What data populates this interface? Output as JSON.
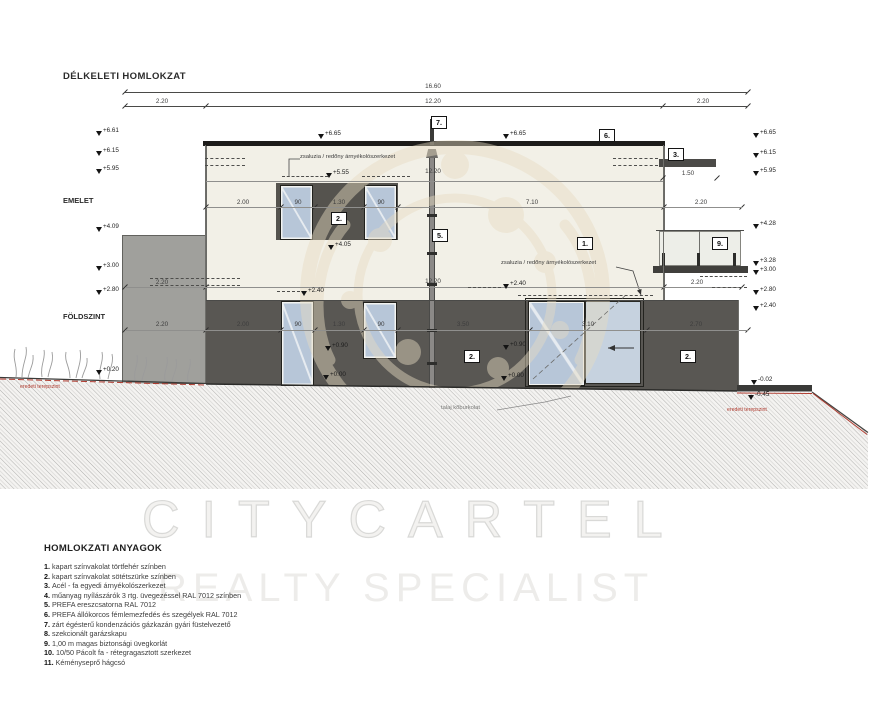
{
  "title": "DÉLKELETI HOMLOKZAT",
  "floors": {
    "upper": "EMELET",
    "ground": "FÖLDSZINT"
  },
  "dims": {
    "total": "16.60",
    "left": "2.20",
    "mid": "12.20",
    "right": "2.20",
    "upper": [
      "2.00",
      "90",
      "1.30",
      "90",
      "7.10"
    ],
    "upper_balcony": "2.20",
    "mid_width_a": "12.20",
    "mid_width_b": "12.20",
    "ground": [
      "2.20",
      "2.00",
      "90",
      "1.30",
      "90",
      "3.50",
      "3.10",
      "2.70"
    ],
    "balcony": "2.20",
    "awning": "1.50"
  },
  "marks_left": [
    "+6.61",
    "+6.15",
    "+5.95",
    "+4.09",
    "+3.00",
    "+2.80",
    "+0.20"
  ],
  "marks_right": [
    "+6.65",
    "+6.15",
    "+5.95",
    "+4.28",
    "+3.28",
    "+3.00",
    "+2.80",
    "+2.40",
    "-0.02",
    "-0.45"
  ],
  "marks_inline": [
    "+6.65",
    "+6.65",
    "+5.55",
    "+4.05",
    "+2.40",
    "+2.40",
    "+0.90",
    "+0.90",
    "+0.00",
    "+0.00"
  ],
  "callouts": {
    "facade_light": "1.",
    "facade_dark_upper": "2.",
    "facade_dark_a": "2.",
    "facade_dark_b": "2.",
    "awning": "3.",
    "gutter": "5.",
    "roof": "6.",
    "flue": "7.",
    "railing": "9."
  },
  "annotations": {
    "shade_upper": "zsaluzia / redőny árnyékolószerkezet",
    "shade_lower": "zsaluzia / redőny árnyékolószerkezet",
    "stone": "talaj kőburkolat",
    "terrain_left": "eredeti terepszint",
    "terrain_right": "eredeti terepszint"
  },
  "legend": {
    "title": "HOMLOKZATI ANYAGOK",
    "items": [
      {
        "n": "1.",
        "t": "kapart színvakolat törtfehér színben"
      },
      {
        "n": "2.",
        "t": "kapart színvakolat sötétszürke színben"
      },
      {
        "n": "3.",
        "t": "Acél - fa egyedi árnyékolószerkezet"
      },
      {
        "n": "4.",
        "t": "műanyag nyílászárók 3 rtg. üvegezéssel  RAL 7012 színben"
      },
      {
        "n": "5.",
        "t": "PREFA ereszcsatorna  RAL 7012"
      },
      {
        "n": "6.",
        "t": "PREFA állókorcos fémlemezfedés és szegélyek RAL 7012"
      },
      {
        "n": "7.",
        "t": "zárt égésterű kondenzációs gázkazán gyári füstelvezető"
      },
      {
        "n": "8.",
        "t": "szekcionált garázskapu"
      },
      {
        "n": "9.",
        "t": "1,00 m magas biztonsági üvegkorlát"
      },
      {
        "n": "10.",
        "t": "10/50 Pácolt fa - rétegragasztott szerkezet"
      },
      {
        "n": "11.",
        "t": "Kéményseprő hágcsó"
      }
    ]
  },
  "watermark": {
    "line1": "CITYCARTEL",
    "line2": "REALTY SPECIALIST"
  },
  "colors": {
    "facade_light": "#f2f0e7",
    "facade_dark": "#595753",
    "glass": "#b7c6d8",
    "roof": "#1d1c1a",
    "terrain_red": "#b03a2e",
    "ornament": "#e7dcc2"
  }
}
